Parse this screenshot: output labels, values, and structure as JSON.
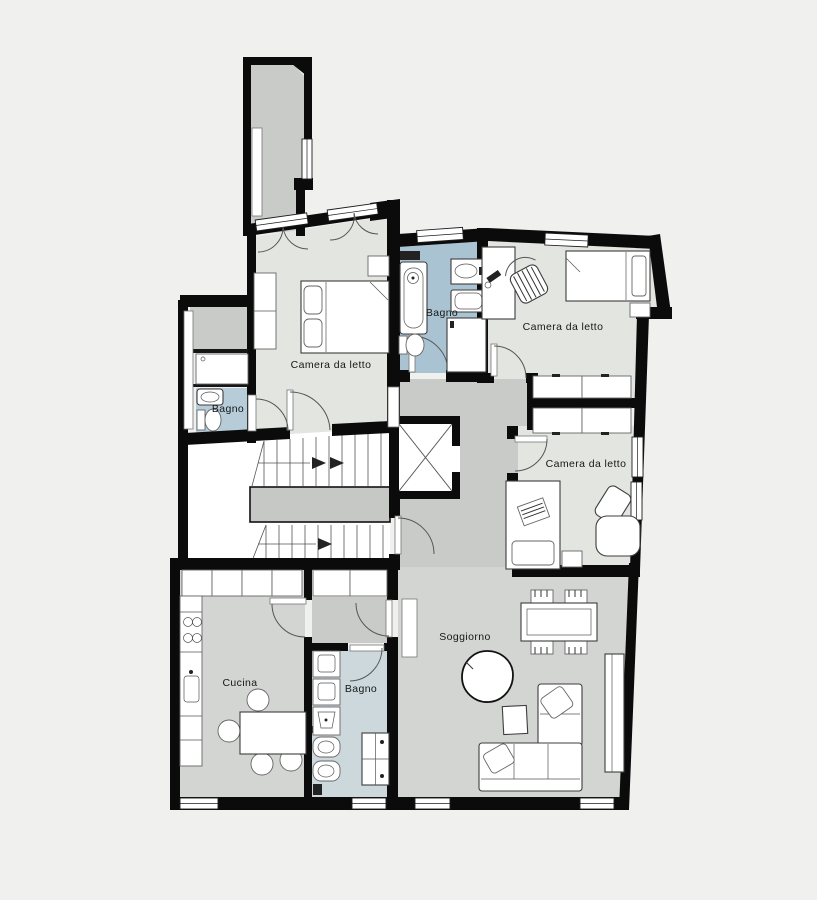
{
  "plan": {
    "type": "apartment-floor-plan",
    "background": "#f0f0ee",
    "colors": {
      "wall": "#0b0b0b",
      "bedroom_floor": "#e3e6e0",
      "bathroom_main_floor": "#a9c3d2",
      "bathroom_small_floor": "#b6ccd9",
      "bathroom_lower_floor": "#ccd8dc",
      "room_gray_floor": "#d3d5d3",
      "corridor_floor": "#c9cbc9",
      "landing_floor": "#c6c8c6",
      "stairwell_floor": "#ffffff"
    },
    "labels": [
      {
        "id": "bedroom-1",
        "text": "Camera da letto"
      },
      {
        "id": "bathroom-main",
        "text": "Bagno"
      },
      {
        "id": "bedroom-2",
        "text": "Camera da letto"
      },
      {
        "id": "bedroom-3",
        "text": "Camera da letto"
      },
      {
        "id": "bathroom-small",
        "text": "Bagno"
      },
      {
        "id": "kitchen",
        "text": "Cucina"
      },
      {
        "id": "bathroom-lower",
        "text": "Bagno"
      },
      {
        "id": "living-room",
        "text": "Soggiorno"
      }
    ]
  }
}
